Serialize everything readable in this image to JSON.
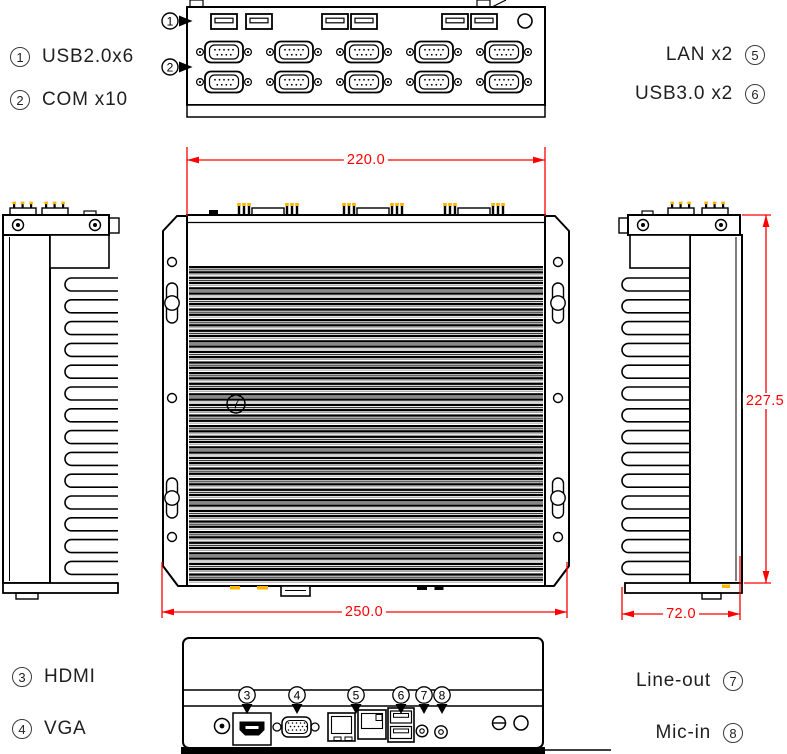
{
  "labels": {
    "top_left": [
      {
        "num": "1",
        "text": "USB2.0x6"
      },
      {
        "num": "2",
        "text": "COM x10"
      }
    ],
    "top_right": [
      {
        "text": "LAN x2",
        "num": "5"
      },
      {
        "text": "USB3.0 x2",
        "num": "6"
      }
    ],
    "bottom_left": [
      {
        "num": "3",
        "text": "HDMI"
      },
      {
        "num": "4",
        "text": "VGA"
      }
    ],
    "bottom_right": [
      {
        "text": "Line-out",
        "num": "7"
      },
      {
        "text": "Mic-in",
        "num": "8"
      }
    ]
  },
  "dimensions": {
    "top_width": "220.0",
    "bottom_width": "250.0",
    "side_height": "227.5",
    "side_depth": "72.0"
  },
  "markers": {
    "top_view": [
      "1",
      "2"
    ],
    "front_view_center": "7",
    "bottom_view": [
      "3",
      "4",
      "5",
      "6",
      "7",
      "8"
    ]
  },
  "ports": {
    "top_usb2_count": 6,
    "top_com_count": 10,
    "bottom_lan_count": 2,
    "bottom_usb3_count": 2
  },
  "colors": {
    "dimension": "#FF0000",
    "connector_accent": "#FFB400",
    "ink": "#000000",
    "background": "#FFFFFF"
  }
}
